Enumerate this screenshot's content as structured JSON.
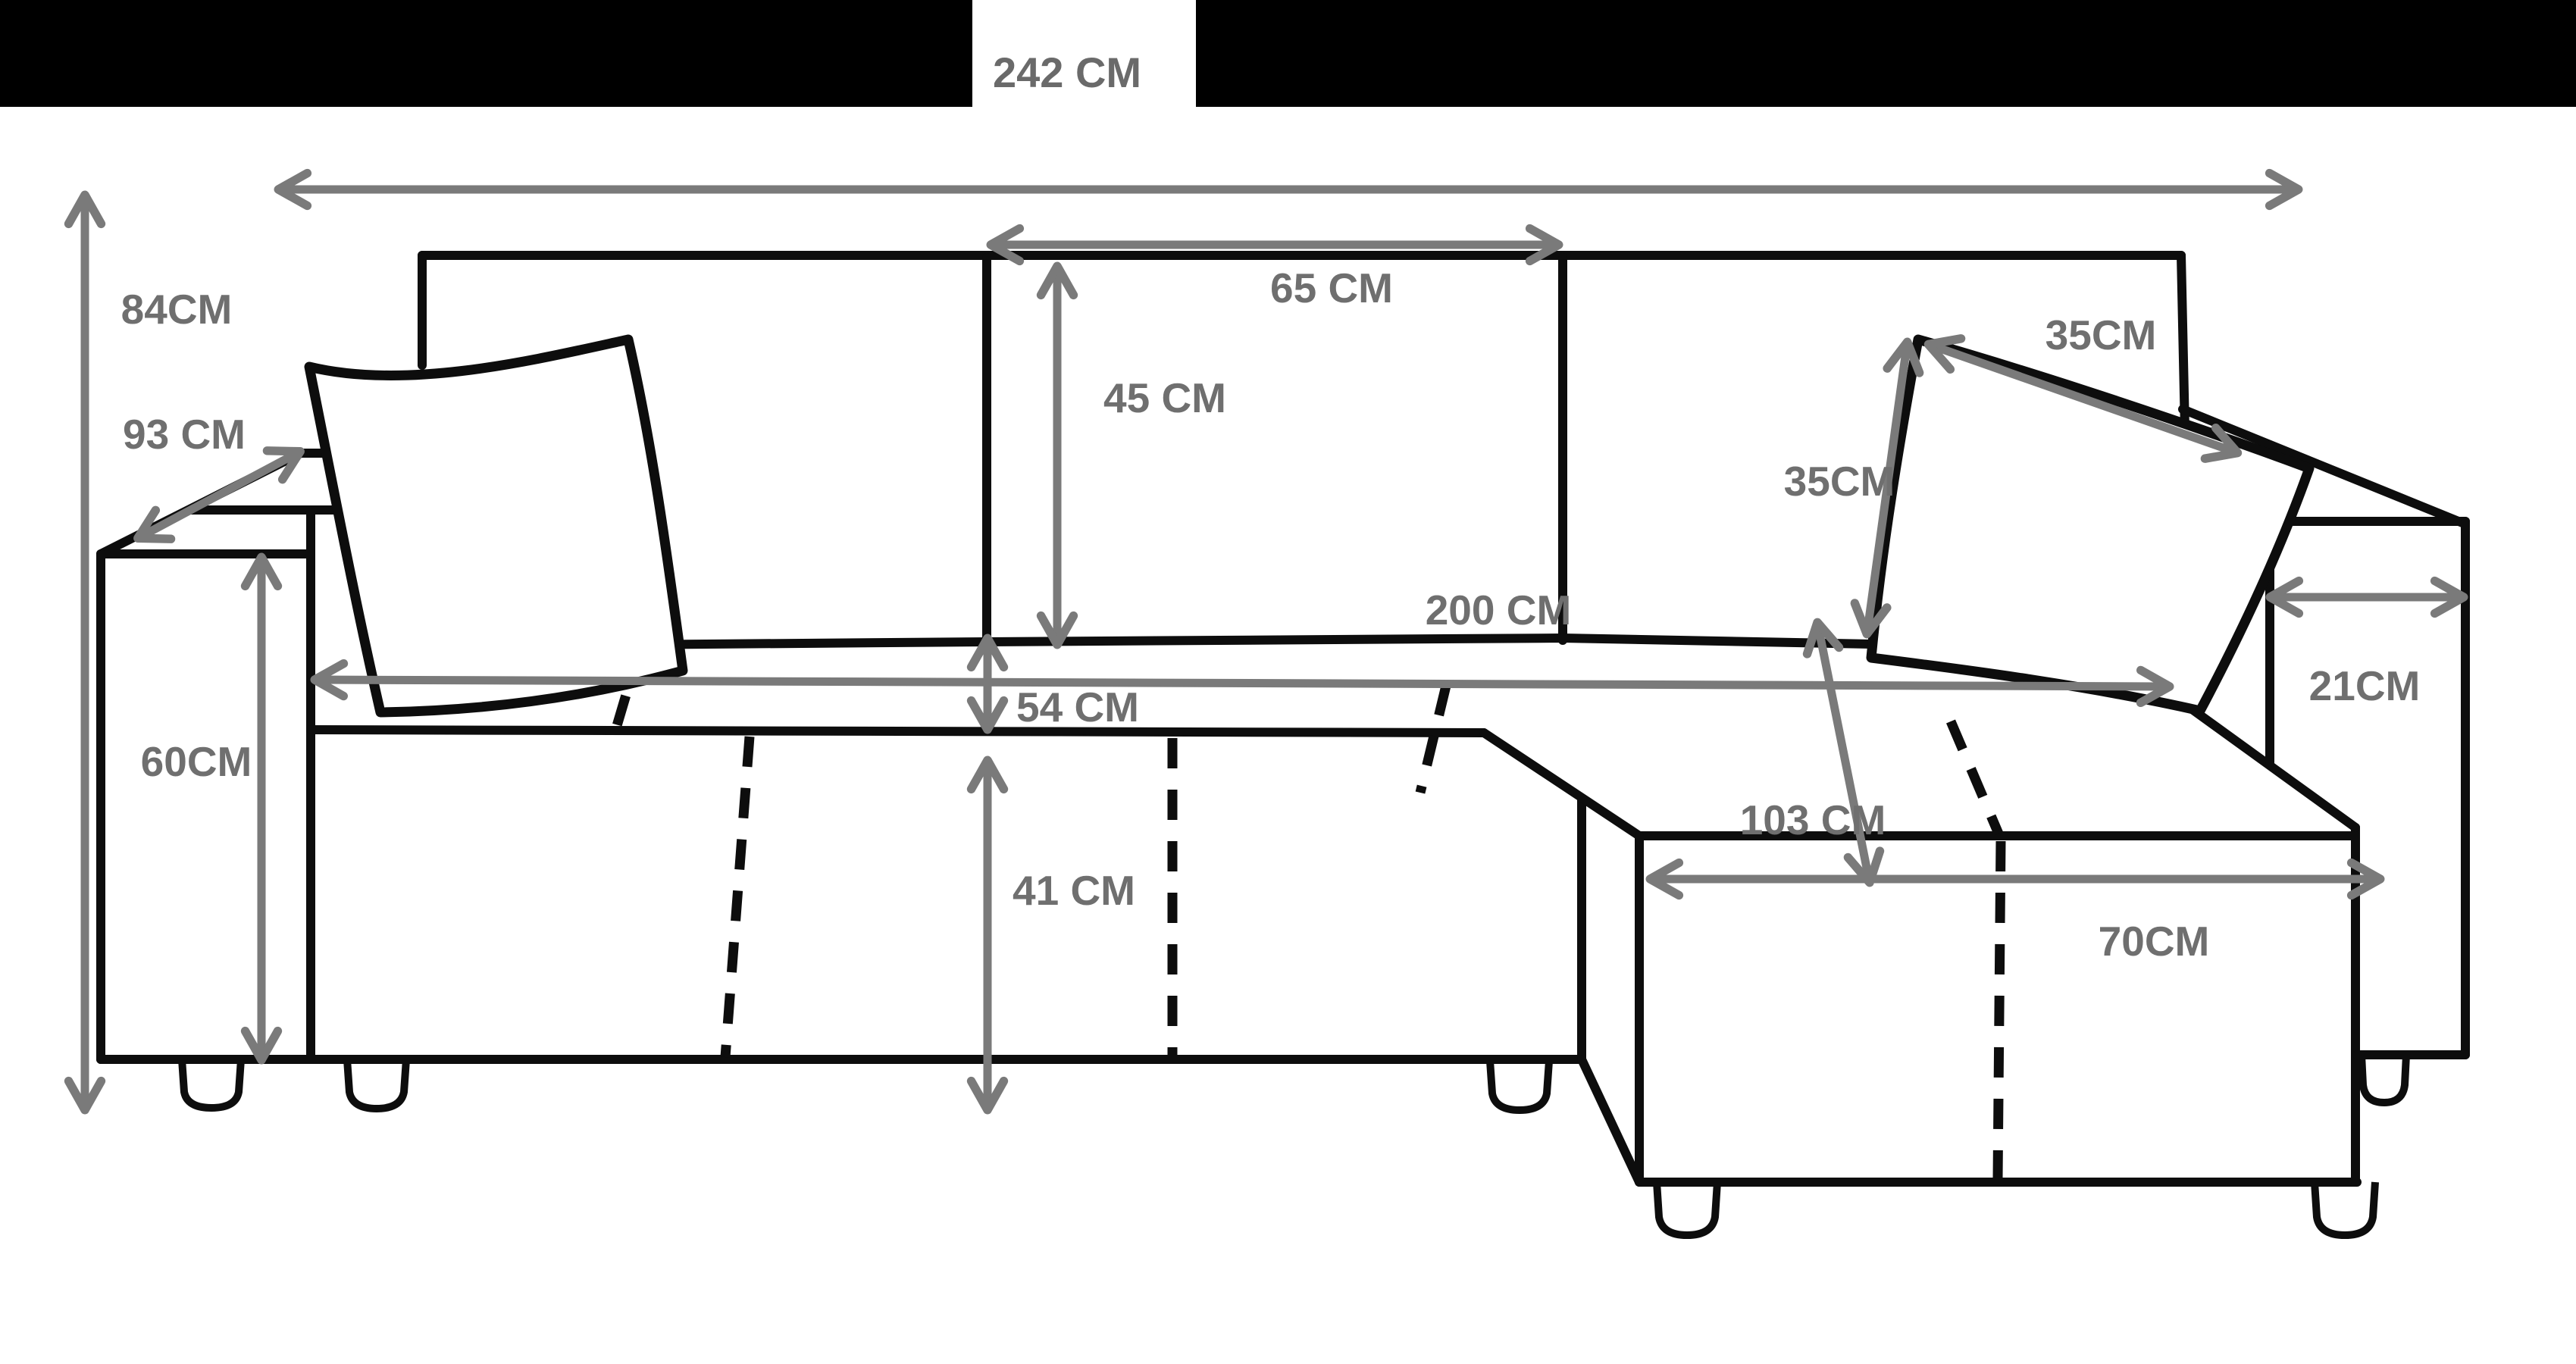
{
  "figure": {
    "type": "furniture-dimension-diagram",
    "subject": "corner sofa with chaise, two cushions and measurement arrows"
  },
  "header": {
    "total_width_label": "242 CM"
  },
  "dimensions": {
    "total_width": {
      "label": "242 CM",
      "meaning": "overall sofa width"
    },
    "total_height": {
      "label": "84CM",
      "meaning": "overall height"
    },
    "depth": {
      "label": "93 CM",
      "meaning": "armrest/seat depth (diagonal)"
    },
    "middle_seat_width": {
      "label": "65 CM",
      "meaning": "middle backrest section width"
    },
    "backrest_height": {
      "label": "45 CM",
      "meaning": "backrest cushion height"
    },
    "pillow_width": {
      "label": "35CM",
      "meaning": "pillow top edge"
    },
    "pillow_height": {
      "label": "35CM",
      "meaning": "pillow side edge"
    },
    "seat_width": {
      "label": "200 CM",
      "meaning": "seat width between armrests"
    },
    "seat_edge": {
      "label": "54 CM",
      "meaning": "seat depth at front seam"
    },
    "armrest_width": {
      "label": "21CM",
      "meaning": "armrest width"
    },
    "armrest_height": {
      "label": "60CM",
      "meaning": "armrest height"
    },
    "chaise_length": {
      "label": "103 CM",
      "meaning": "chaise depth"
    },
    "base_height": {
      "label": "41 CM",
      "meaning": "base front height"
    },
    "chaise_width": {
      "label": "70CM",
      "meaning": "chaise front width"
    }
  },
  "colors": {
    "background": "#ffffff",
    "header_bar": "#000000",
    "line_art": "#0d0d0d",
    "arrow": "#7a7a7a",
    "label_text": "#6f6f6f"
  }
}
